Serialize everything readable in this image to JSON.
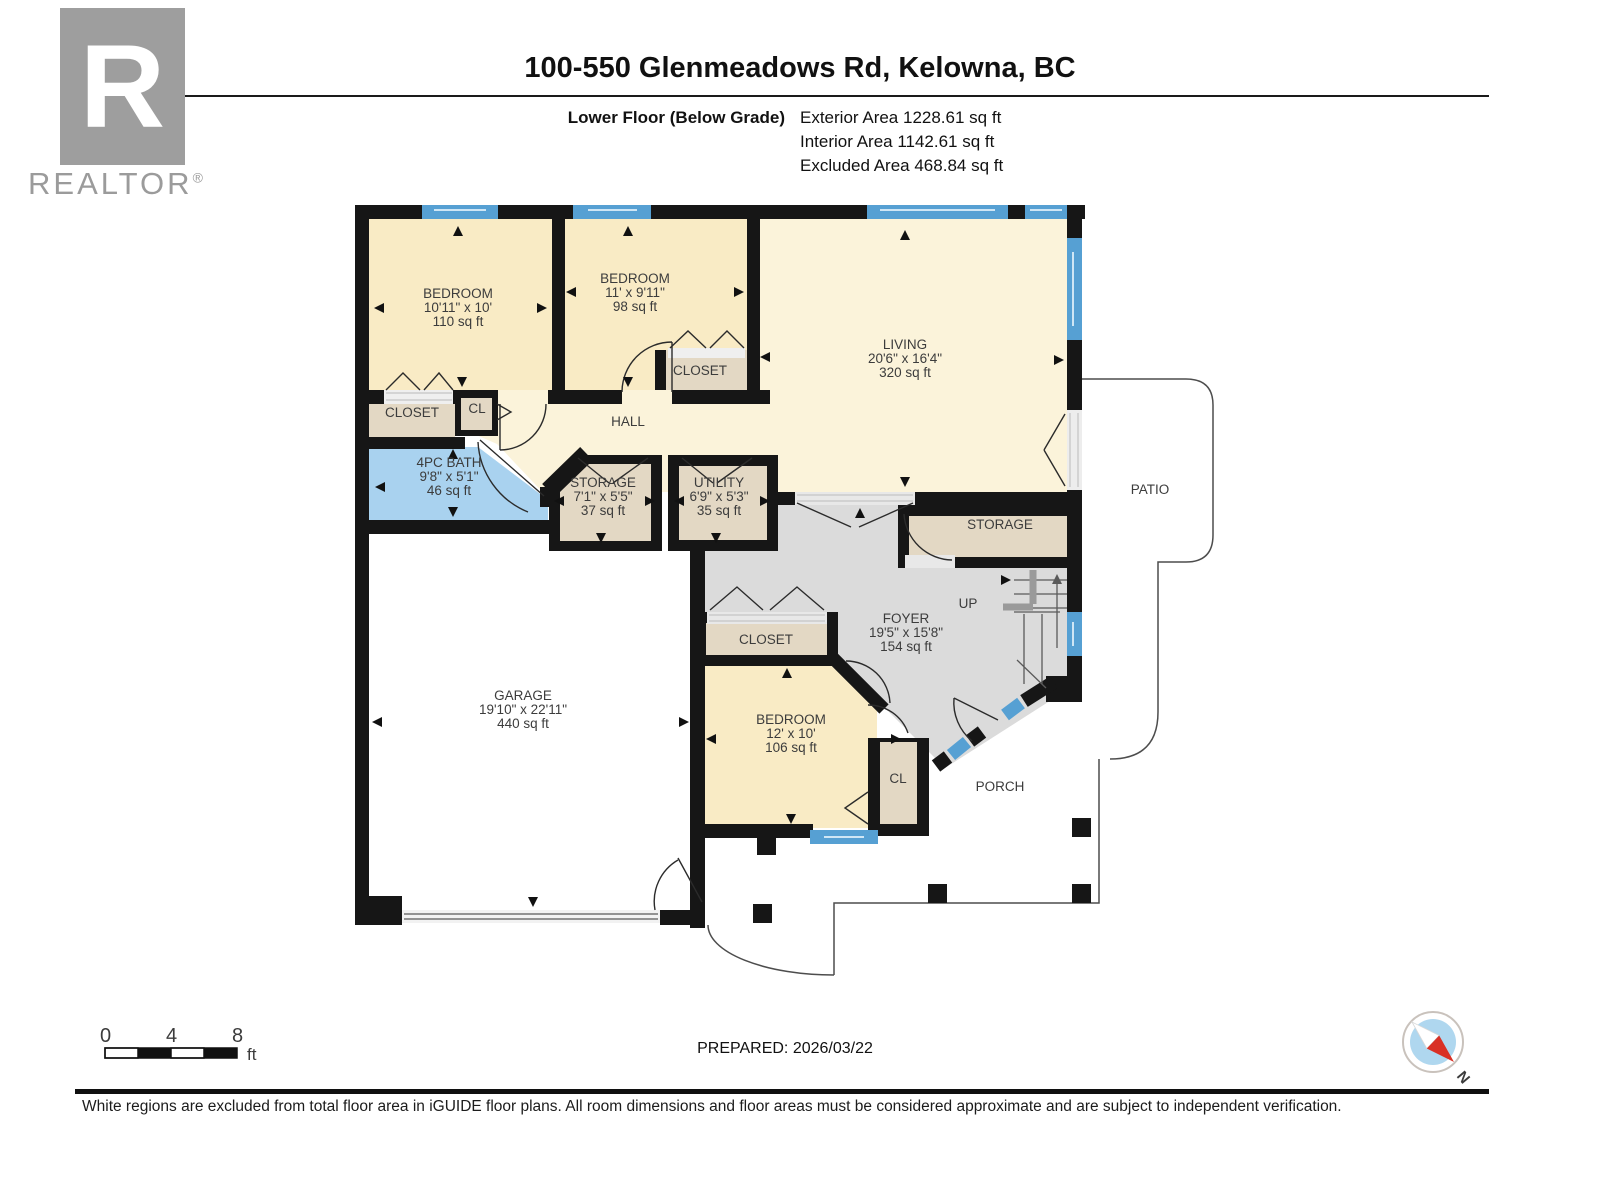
{
  "header": {
    "logo_letter": "R",
    "logo_brand": "REALTOR",
    "logo_reg": "®",
    "title": "100-550 Glenmeadows Rd, Kelowna, BC",
    "floor_label": "Lower Floor (Below Grade)",
    "areas": [
      "Exterior Area 1228.61 sq ft",
      "Interior Area 1142.61 sq ft",
      "Excluded Area 468.84 sq ft"
    ]
  },
  "rooms": {
    "bedroom_left": {
      "name": "BEDROOM",
      "dims": "10'11\" x 10'",
      "area": "110 sq ft"
    },
    "bedroom_mid": {
      "name": "BEDROOM",
      "dims": "11' x 9'11\"",
      "area": "98 sq ft"
    },
    "living": {
      "name": "LIVING",
      "dims": "20'6\" x 16'4\"",
      "area": "320 sq ft"
    },
    "bath": {
      "name": "4PC BATH",
      "dims": "9'8\" x 5'1\"",
      "area": "46 sq ft"
    },
    "storage": {
      "name": "STORAGE",
      "dims": "7'1\" x 5'5\"",
      "area": "37 sq ft"
    },
    "utility": {
      "name": "UTILITY",
      "dims": "6'9\" x 5'3\"",
      "area": "35 sq ft"
    },
    "foyer": {
      "name": "FOYER",
      "dims": "19'5\" x 15'8\"",
      "area": "154 sq ft"
    },
    "garage": {
      "name": "GARAGE",
      "dims": "19'10\" x 22'11\"",
      "area": "440 sq ft"
    },
    "bedroom_lower": {
      "name": "BEDROOM",
      "dims": "12' x 10'",
      "area": "106 sq ft"
    }
  },
  "labels": {
    "closet": "CLOSET",
    "cl": "CL",
    "hall": "HALL",
    "storage2": "STORAGE",
    "up": "UP",
    "porch": "PORCH",
    "patio": "PATIO"
  },
  "scale_bar": {
    "ticks": [
      "0",
      "4",
      "8"
    ],
    "unit": "ft"
  },
  "footer": {
    "prepared": "PREPARED: 2026/03/22",
    "disclaimer": "White regions are excluded from total floor area in iGUIDE floor plans. All room dimensions and floor areas must be considered approximate and are subject to independent verification.",
    "compass_n": "N"
  },
  "colors": {
    "wall": "#161616",
    "bedroom_fill": "#F9EBC5",
    "living_fill": "#FBF3DA",
    "closet_fill": "#E3D8C4",
    "bath_fill": "#A9D2EF",
    "foyer_fill": "#DBDBDB",
    "window_blue": "#56A0D3",
    "logo_gray": "#9e9e9e"
  }
}
